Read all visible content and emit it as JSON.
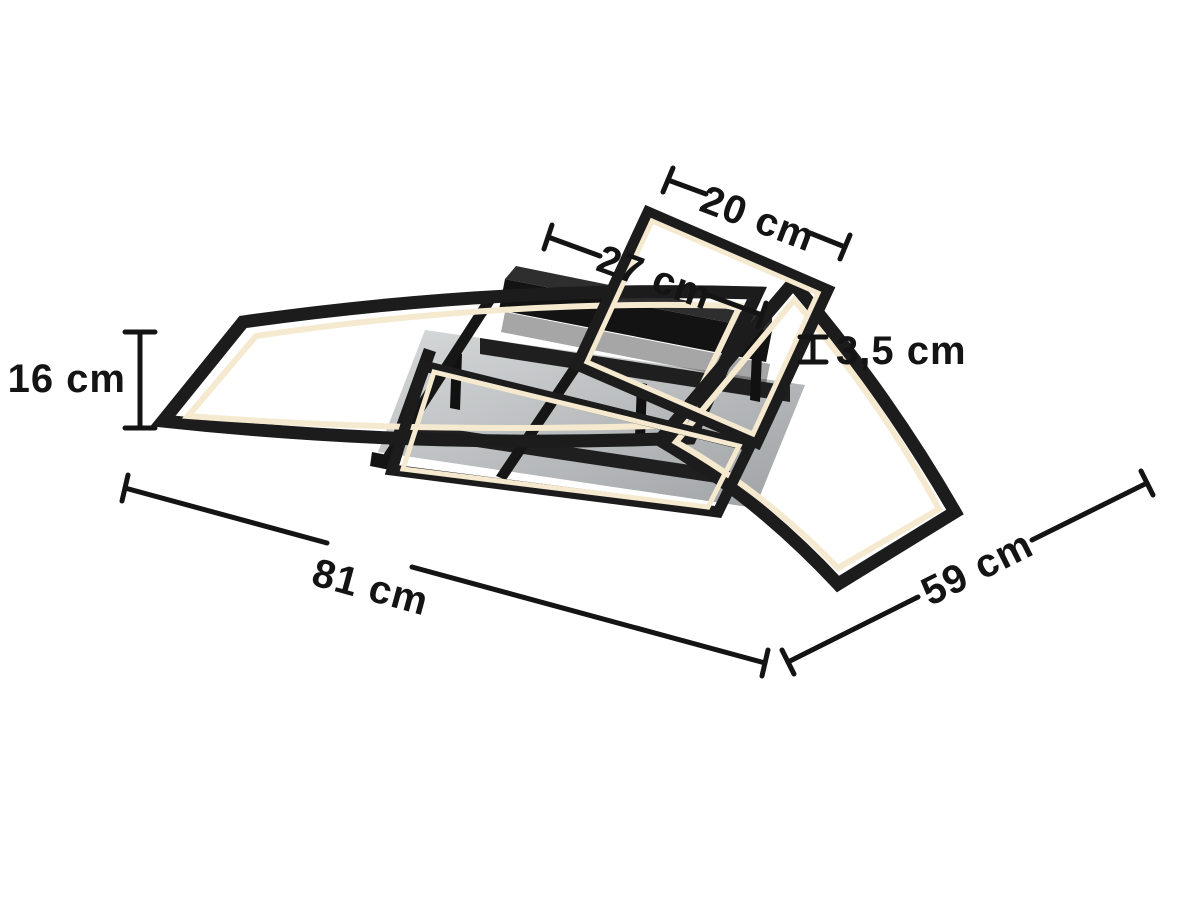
{
  "diagram": {
    "illustration": "led-ceiling-light",
    "colors": {
      "background": "#ffffff",
      "line": "#141414",
      "frame": "#1c1c1c",
      "led": "#f5ead0",
      "panel_light": "#d6d9da",
      "panel_dark": "#9fa2a4",
      "canopy": "#131313",
      "canopy_top": "#2e2e2e"
    },
    "dimensions": [
      {
        "id": "top-frame-width",
        "label": "20 cm"
      },
      {
        "id": "middle-frame-width",
        "label": "27 cm"
      },
      {
        "id": "profile-height",
        "label": "3,5 cm"
      },
      {
        "id": "fixture-height",
        "label": "16 cm"
      },
      {
        "id": "overall-width",
        "label": "81 cm"
      },
      {
        "id": "overall-depth",
        "label": "59 cm"
      }
    ]
  }
}
